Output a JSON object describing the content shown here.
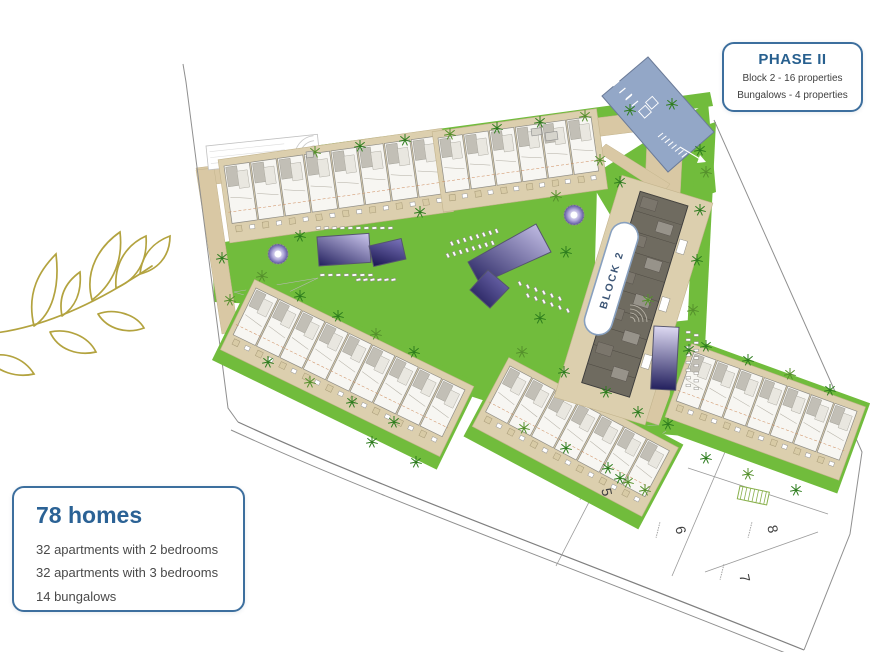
{
  "phase_box": {
    "title": "PHASE II",
    "lines": [
      "Block 2 - 16 properties",
      "Bungalows - 4 properties"
    ]
  },
  "homes_box": {
    "title": "78 homes",
    "lines": [
      "32 apartments with 2 bedrooms",
      "32 apartments with 3 bedrooms",
      "14 bungalows"
    ]
  },
  "site_plan": {
    "block_label": "BLOCK 2",
    "plot_numbers": [
      "5",
      "6",
      "7",
      "8"
    ]
  },
  "icons": [
    "olive-branch-icon",
    "palm-tree-icon",
    "fountain-icon",
    "pool-icon",
    "parking-icon"
  ],
  "colors": {
    "lawn": "#71bc3c",
    "tree": "#2e7d1e",
    "tan": "#dccfae",
    "tan_path": "#d9c8a4",
    "parking_blue": "#93a7c7",
    "pool_dark": "#23205e",
    "pool_light": "#c6c0ea",
    "accent_blue": "#3d6f9e",
    "title_blue": "#28608f",
    "text_dark": "#4a4a4a",
    "olive": "#b3a33f",
    "building": "#6f6b60",
    "block_text": "#3d5676",
    "hatch_green": "#88b04b"
  }
}
